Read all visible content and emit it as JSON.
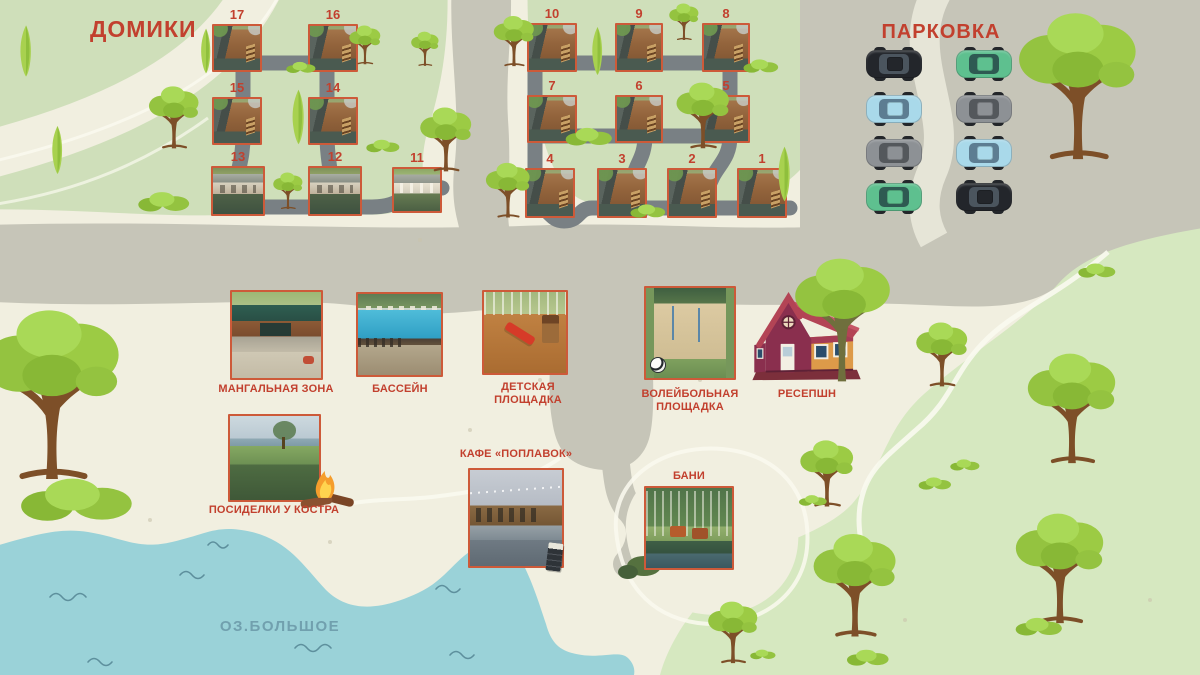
{
  "map": {
    "cabins": {
      "title": "ДОМИКИ",
      "items": [
        {
          "number": "17"
        },
        {
          "number": "16"
        },
        {
          "number": "15"
        },
        {
          "number": "14"
        },
        {
          "number": "13"
        },
        {
          "number": "12"
        },
        {
          "number": "11"
        },
        {
          "number": "10"
        },
        {
          "number": "9"
        },
        {
          "number": "8"
        },
        {
          "number": "7"
        },
        {
          "number": "6"
        },
        {
          "number": "5"
        },
        {
          "number": "4"
        },
        {
          "number": "3"
        },
        {
          "number": "2"
        },
        {
          "number": "1"
        }
      ]
    },
    "parking": {
      "title": "ПАРКОВКА",
      "cars": [
        {
          "name": "black-car",
          "color": "#23262b",
          "glass": "#4b555e"
        },
        {
          "name": "green-car",
          "color": "#5ec08f",
          "glass": "#2e5a52"
        },
        {
          "name": "blue-car",
          "color": "#a9d9ea",
          "glass": "#5d7d92"
        },
        {
          "name": "gray-car",
          "color": "#8d9195",
          "glass": "#54585c"
        },
        {
          "name": "gray-car",
          "color": "#8d9195",
          "glass": "#54585c"
        },
        {
          "name": "blue-car",
          "color": "#a9d9ea",
          "glass": "#5d7d92"
        },
        {
          "name": "green-car",
          "color": "#5ec08f",
          "glass": "#2e5a52"
        },
        {
          "name": "black-car",
          "color": "#23262b",
          "glass": "#4b555e"
        }
      ]
    },
    "amenities": [
      {
        "id": "bbq-zone",
        "label": "МАНГАЛЬНАЯ ЗОНА"
      },
      {
        "id": "pool",
        "label": "БАССЕЙН"
      },
      {
        "id": "playground",
        "label": "ДЕТСКАЯ ПЛОЩАДКА"
      },
      {
        "id": "volleyball-court",
        "label": "ВОЛЕЙБОЛЬНАЯ ПЛОЩАДКА"
      },
      {
        "id": "reception",
        "label": "РЕСЕПШН"
      },
      {
        "id": "campfire",
        "label": "ПОСИДЕЛКИ У КОСТРА"
      },
      {
        "id": "cafe",
        "label": "КАФЕ «ПОПЛАВОК»"
      },
      {
        "id": "banya",
        "label": "БАНИ"
      }
    ],
    "lake": {
      "label": "ОЗ.БОЛЬШОЕ"
    },
    "colors": {
      "label_red": "#c2402e",
      "photo_border": "#cd5a39",
      "water": "#9ad2d8",
      "road": "#c6c5b8",
      "inner_road": "#798084",
      "grass_light": "#cfdfba",
      "grass_dark": "#d6e8c0",
      "background": "#f1efe0",
      "lake_label": "#71a0ae"
    }
  }
}
